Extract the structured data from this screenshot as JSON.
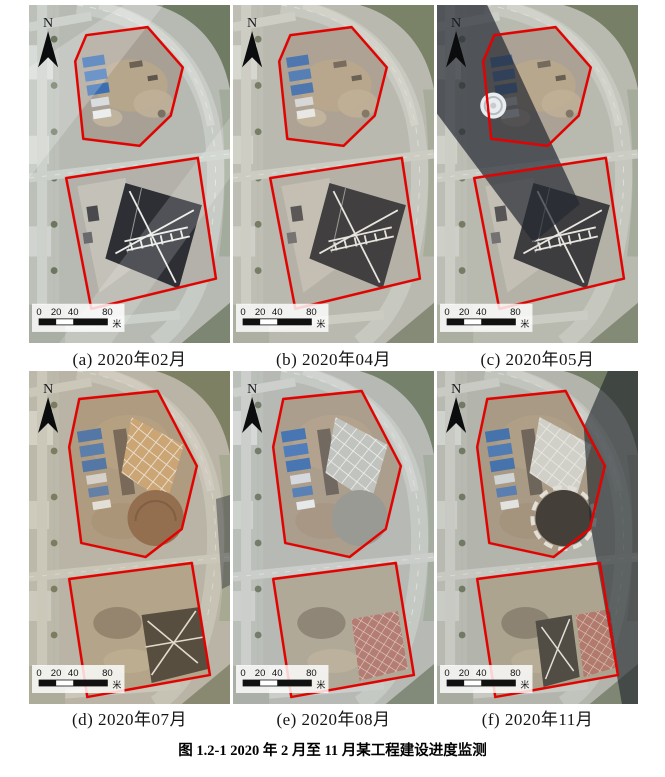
{
  "figure": {
    "caption": "图 1.2-1 2020 年 2 月至 11 月某工程建设进度监测"
  },
  "map": {
    "north_label": "N",
    "scalebar": {
      "ticks": [
        "0",
        "20",
        "40",
        "80"
      ],
      "unit": "米"
    }
  },
  "colors": {
    "site_outline": "#e60000",
    "north_arrow": "#0b0c0e",
    "road": "#c7cbc5",
    "ground": "#b7bab3",
    "page_background": "#ffffff"
  },
  "panels": [
    {
      "id": "a",
      "caption": "(a) 2020年02月",
      "scene": {
        "layout": "top",
        "haze": true,
        "tint": null,
        "tintOpacity": 0,
        "shadow": "none",
        "helipad": false
      }
    },
    {
      "id": "b",
      "caption": "(b) 2020年04月",
      "scene": {
        "layout": "top",
        "haze": false,
        "tint": "#cab698",
        "tintOpacity": 0.12,
        "shadow": "none",
        "helipad": false
      }
    },
    {
      "id": "c",
      "caption": "(c) 2020年05月",
      "scene": {
        "layout": "top",
        "haze": false,
        "tint": "#c8ae90",
        "tintOpacity": 0.1,
        "shadow": "left-diagonal",
        "helipad": true
      }
    },
    {
      "id": "d",
      "caption": "(d) 2020年07月",
      "scene": {
        "layout": "bottom",
        "tint": "#c49a6a",
        "tintOpacity": 0.18,
        "shadow": "right-small",
        "lattice": "#cfa878",
        "circle": "#8a664a",
        "circleRing": false,
        "lowerStyle": "dark"
      }
    },
    {
      "id": "e",
      "caption": "(e) 2020年08月",
      "scene": {
        "layout": "bottom",
        "tint": "#b6bcc0",
        "tintOpacity": 0.1,
        "shadow": "none",
        "lattice": "#c2c4bf",
        "circle": "#97978f",
        "circleRing": false,
        "lowerStyle": "red"
      }
    },
    {
      "id": "f",
      "caption": "(f) 2020年11月",
      "scene": {
        "layout": "bottom",
        "tint": "#9a9286",
        "tintOpacity": 0.12,
        "shadow": "right-edge",
        "lattice": "#d8d8d2",
        "circle": "#38342e",
        "circleRing": true,
        "lowerStyle": "both"
      }
    }
  ]
}
